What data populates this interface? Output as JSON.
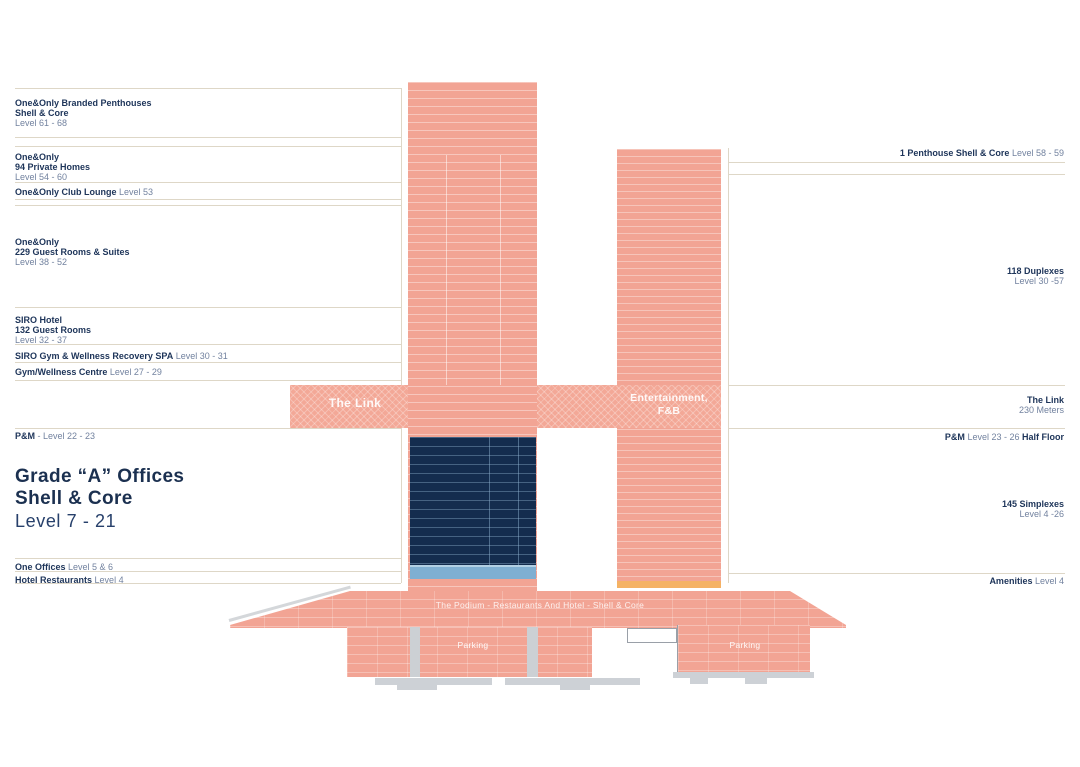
{
  "left": {
    "penthouses": {
      "t1": "One&Only Branded Penthouses",
      "t2": "Shell & Core",
      "lvl": "Level 61 - 68"
    },
    "private_homes": {
      "t1": "One&Only",
      "t2": "94 Private Homes",
      "lvl": "Level 54 - 60"
    },
    "club_lounge": {
      "t1": "One&Only Club Lounge",
      "lvl": "Level 53"
    },
    "guest_rooms": {
      "t1": "One&Only",
      "t2": "229 Guest Rooms & Suites",
      "lvl": "Level 38 - 52"
    },
    "siro_hotel": {
      "t1": "SIRO Hotel",
      "t2": "132 Guest Rooms",
      "lvl": "Level 32 - 37"
    },
    "siro_spa": {
      "t1": "SIRO Gym & Wellness Recovery SPA",
      "lvl": "Level 30 - 31"
    },
    "gym_wellness": {
      "t1": "Gym/Wellness Centre",
      "lvl": "Level 27 - 29"
    },
    "pm": {
      "t1": "P&M",
      "lvl": "- Level 22 - 23"
    },
    "offices_title": {
      "t1": "Grade “A”  Offices",
      "t2": "Shell & Core",
      "lvl": "Level  7 - 21"
    },
    "one_offices": {
      "t1": "One Offices",
      "lvl": "Level  5 & 6"
    },
    "hotel_restaurants": {
      "t1": "Hotel Restaurants",
      "lvl": "Level  4"
    }
  },
  "right": {
    "penthouse": {
      "t1": "1 Penthouse Shell & Core",
      "lvl": "Level 58 - 59"
    },
    "duplexes": {
      "t1": "118 Duplexes",
      "lvl": "Level  30 -57"
    },
    "link": {
      "t1": "The Link",
      "lvl": "230 Meters"
    },
    "pm_half": {
      "t1": "P&M",
      "lvl": "Level 23 - 26",
      "t2": "Half Floor"
    },
    "simplexes": {
      "t1": "145 Simplexes",
      "lvl": "Level 4 -26"
    },
    "amenities": {
      "t1": "Amenities",
      "lvl": "Level 4"
    }
  },
  "building": {
    "link_label": "The Link",
    "entertainment_l1": "Entertainment,",
    "entertainment_l2": "F&B",
    "podium_label": "The Podium - Restaurants And Hotel - Shell & Core",
    "parking_left": "Parking",
    "parking_right": "Parking"
  },
  "colors": {
    "tower_salmon": "#f2a494",
    "link_salmon": "#f3a897",
    "offices_navy": "#142c4e",
    "offices_blue_band": "#7fafd2",
    "amenities_orange": "#f5b264",
    "text_navy": "#1d3459",
    "text_light": "#72829f",
    "rule_line": "#ded7c7",
    "podium_gray": "#cdd1d6"
  }
}
